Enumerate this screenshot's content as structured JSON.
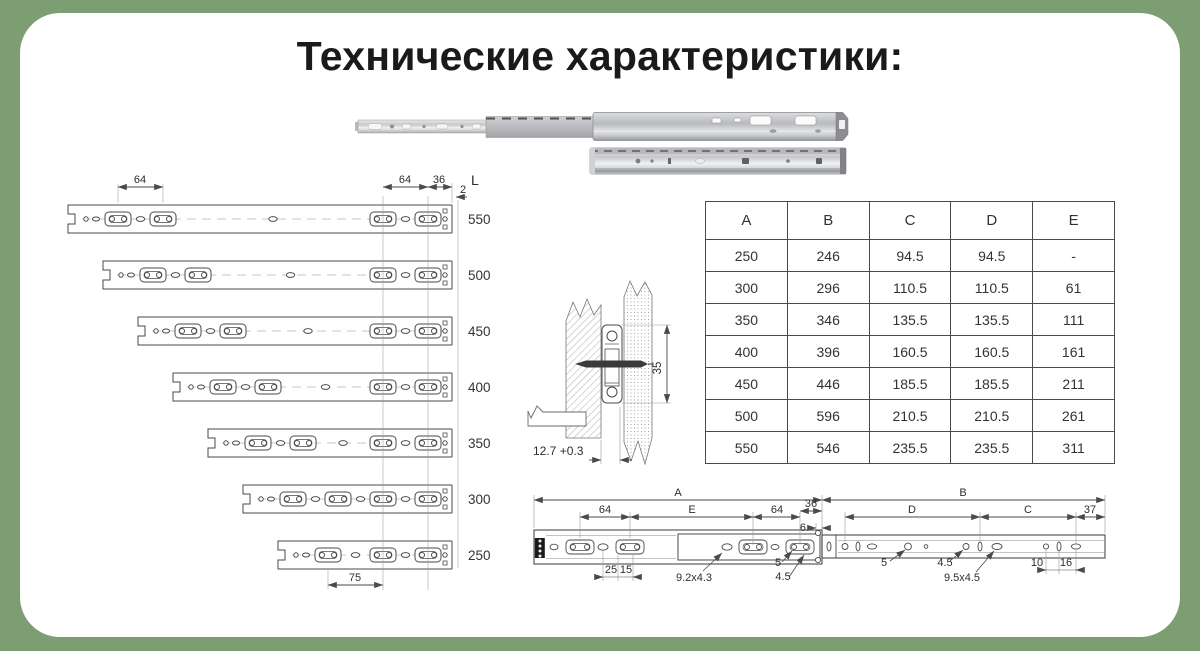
{
  "title": "Технические характеристики:",
  "colors": {
    "background": "#7d9d73",
    "card": "#ffffff",
    "line": "#4a4a4a"
  },
  "length_diagram": {
    "l_header": "L",
    "lengths": [
      "550",
      "500",
      "450",
      "400",
      "350",
      "300",
      "250"
    ],
    "dim_left_64": "64",
    "dim_right_64": "64",
    "dim_36": "36",
    "dim_2": "2",
    "dim_75": "75"
  },
  "mounting": {
    "dim_35": "35",
    "dim_127": "12.7 +0.3"
  },
  "spec_table": {
    "columns": [
      "A",
      "B",
      "C",
      "D",
      "E"
    ],
    "rows": [
      [
        "250",
        "246",
        "94.5",
        "94.5",
        "-"
      ],
      [
        "300",
        "296",
        "110.5",
        "110.5",
        "61"
      ],
      [
        "350",
        "346",
        "135.5",
        "135.5",
        "111"
      ],
      [
        "400",
        "396",
        "160.5",
        "160.5",
        "161"
      ],
      [
        "450",
        "446",
        "185.5",
        "185.5",
        "211"
      ],
      [
        "500",
        "596",
        "210.5",
        "210.5",
        "261"
      ],
      [
        "550",
        "546",
        "235.5",
        "235.5",
        "311"
      ]
    ]
  },
  "profile": {
    "dim_A": "A",
    "dim_B": "B",
    "dim_C": "C",
    "dim_D": "D",
    "dim_E": "E",
    "dim_64a": "64",
    "dim_64b": "64",
    "dim_36": "36",
    "dim_6": "6",
    "dim_37": "37",
    "dim_25": "25",
    "dim_15": "15",
    "dim_92x43": "9.2x4.3",
    "dim_5a": "5",
    "dim_45a": "4.5",
    "dim_5b": "5",
    "dim_45b": "4.5",
    "dim_95x45": "9.5x4.5",
    "dim_10": "10",
    "dim_16": "16"
  }
}
